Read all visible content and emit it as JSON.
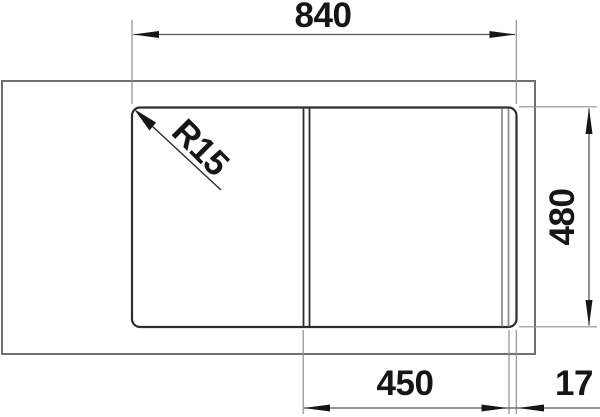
{
  "drawing": {
    "title": "sink-dimension-drawing",
    "dimensions": {
      "overall_width": "840",
      "overall_depth": "480",
      "bowl_width": "450",
      "edge_offset": "17",
      "corner_radius": "R15"
    },
    "colors": {
      "background": "#ffffff",
      "object_line": "#2d2d2d",
      "counter_line": "#6f6f6f",
      "secondary_line": "#8e8e8e",
      "dimension_line": "#585858",
      "text_and_arrows": "#161616"
    }
  }
}
